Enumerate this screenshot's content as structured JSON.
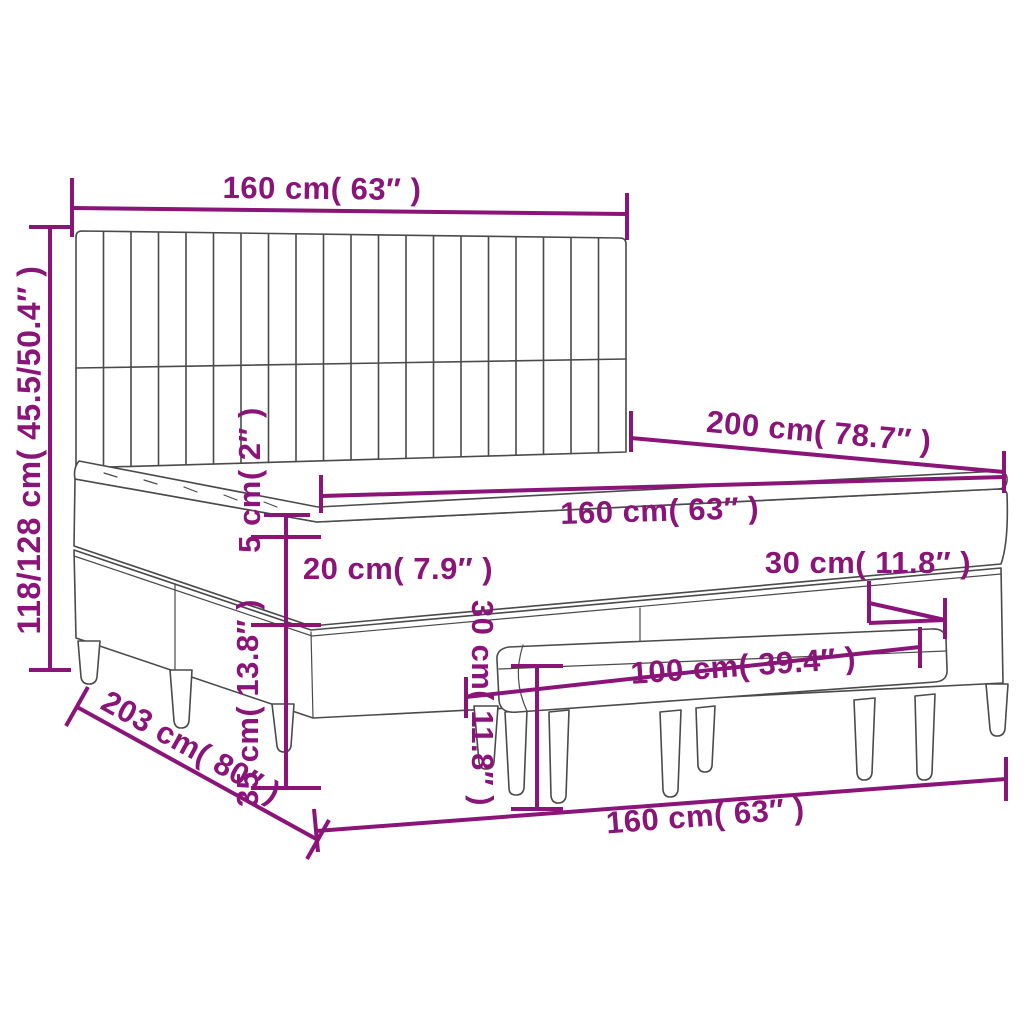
{
  "title": "Box spring bed with headboard and bench - dimension diagram",
  "colors": {
    "dimension": "#8A1478",
    "line_art": "#4a4a4a",
    "background": "#ffffff"
  },
  "dims": {
    "headboard_width": "160 cm( 63″ )",
    "bed_height": "118/128 cm( 45.5/50.4″ )",
    "bed_length": "200 cm( 78.7″ )",
    "mattress_width": "160 cm( 63″ )",
    "pillowtop_height": "5 cm( 2″ )",
    "mattress_height": "20 cm( 7.9″ )",
    "base_height": "35 cm( 13.8″ )",
    "bench_seat_height": "30 cm( 11.8″ )",
    "bench_depth": "30 cm( 11.8″ )",
    "bench_width": "100 cm( 39.4″ )",
    "bed_width_floor": "160 cm( 63″ )",
    "bed_length_floor": "203 cm( 80″ )"
  }
}
